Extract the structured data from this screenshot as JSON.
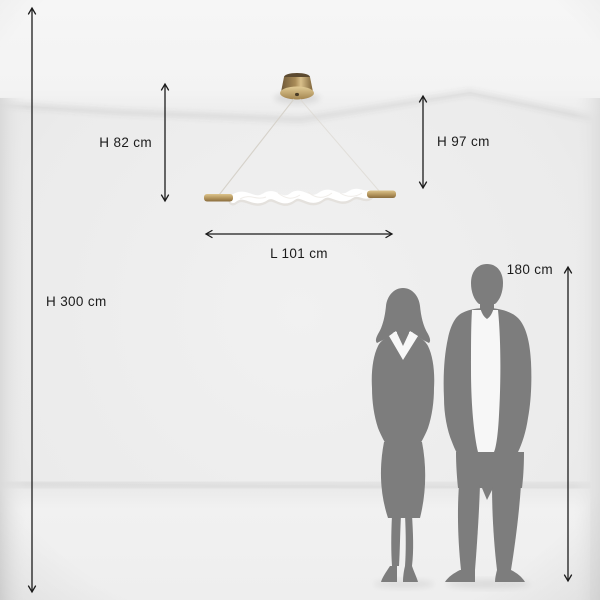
{
  "diagram": {
    "subject": "pendant-lamp-size-diagram",
    "dimension_labels": {
      "room_height": "H 300 cm",
      "hanging_height_left": "H 82 cm",
      "hanging_height_right": "H 97 cm",
      "lamp_length": "L 101 cm",
      "person_height": "180 cm"
    },
    "colors": {
      "arrow_and_text": "#1b1b1b",
      "silhouette_gray": "#7d7d7d",
      "brass_light": "#d9c08b",
      "brass_mid": "#b3945c",
      "brass_dark": "#6d5737",
      "wall": "#ebebeb",
      "ceiling": "#f5f5f5",
      "floor": "#f0f0f0",
      "diffuser_white": "#ffffff"
    }
  }
}
